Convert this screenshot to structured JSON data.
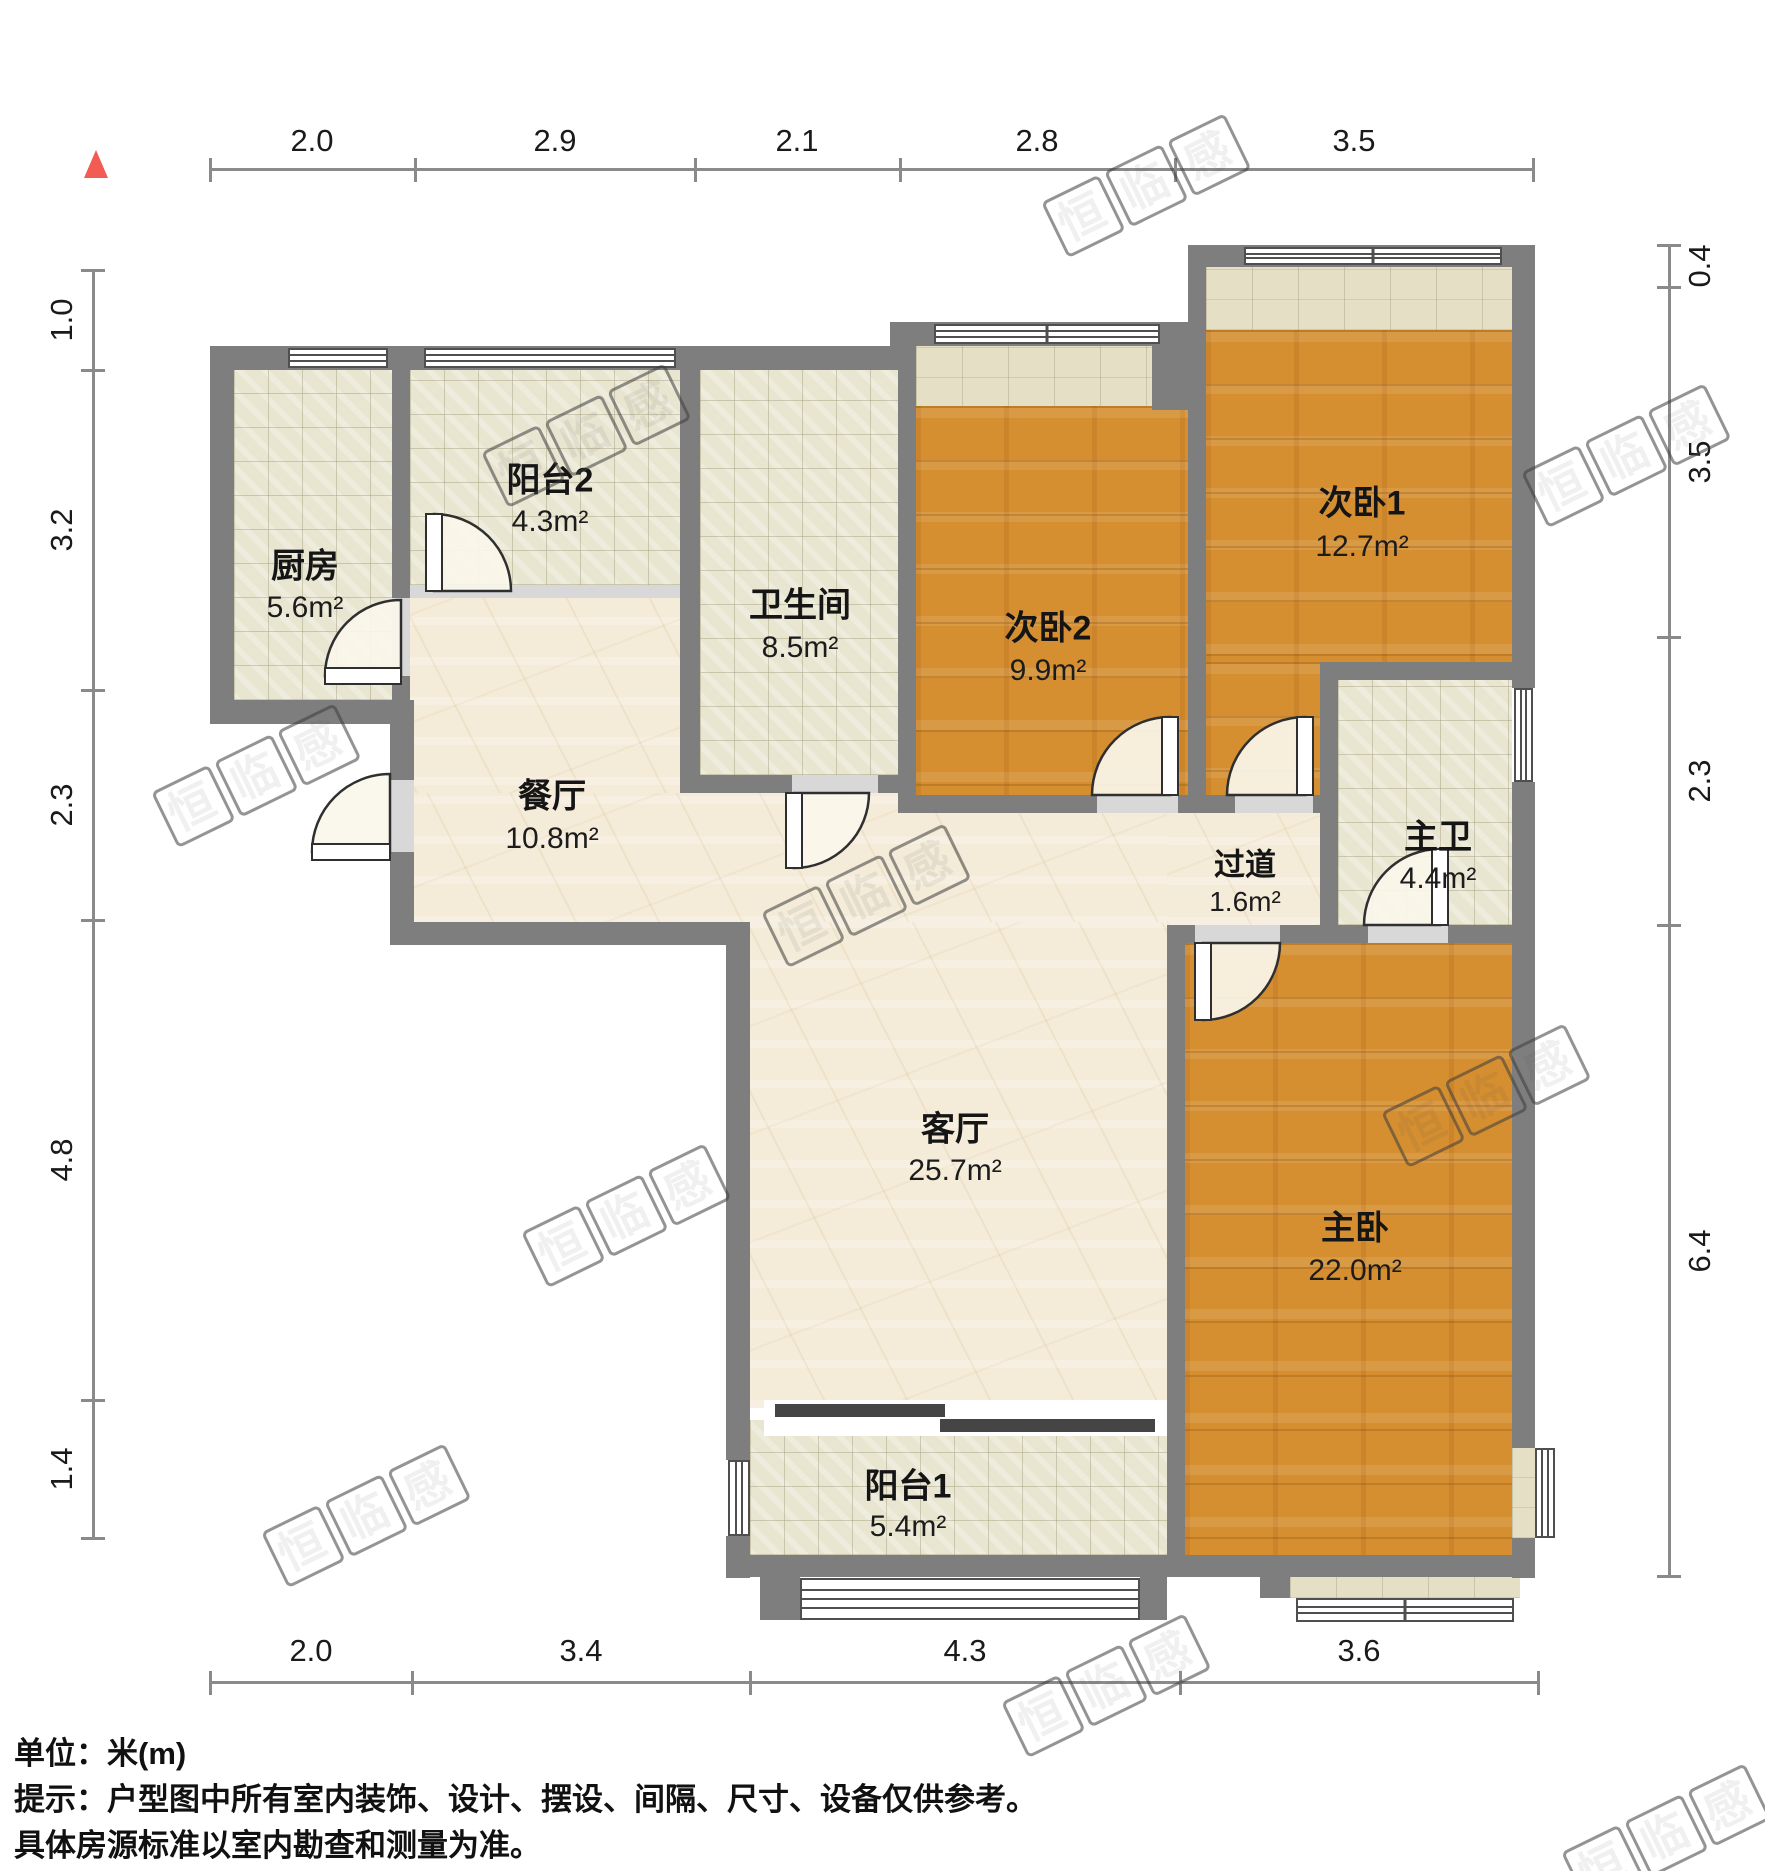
{
  "title": "户型图",
  "unit_scale": "米(m)",
  "compass": {
    "icon": "north-arrow",
    "color": "#f25c54"
  },
  "rooms": {
    "kitchen": {
      "name": "厨房",
      "area": "5.6m²"
    },
    "balcony2": {
      "name": "阳台2",
      "area": "4.3m²"
    },
    "bathroom": {
      "name": "卫生间",
      "area": "8.5m²"
    },
    "bedroom2": {
      "name": "次卧2",
      "area": "9.9m²"
    },
    "bedroom1": {
      "name": "次卧1",
      "area": "12.7m²"
    },
    "dining": {
      "name": "餐厅",
      "area": "10.8m²"
    },
    "hallway": {
      "name": "过道",
      "area": "1.6m²"
    },
    "master_bath": {
      "name": "主卫",
      "area": "4.4m²"
    },
    "living": {
      "name": "客厅",
      "area": "25.7m²"
    },
    "master_bedroom": {
      "name": "主卧",
      "area": "22.0m²"
    },
    "balcony1": {
      "name": "阳台1",
      "area": "5.4m²"
    }
  },
  "dimensions": {
    "top": [
      "2.0",
      "2.9",
      "2.1",
      "2.8",
      "3.5"
    ],
    "left": [
      "1.0",
      "3.2",
      "2.3",
      "4.8",
      "1.4"
    ],
    "right": [
      "0.4",
      "3.5",
      "2.3",
      "6.4"
    ],
    "bottom": [
      "2.0",
      "3.4",
      "4.3",
      "3.6"
    ]
  },
  "footer": {
    "unit_line": "单位：米(m)",
    "notice_line1": "提示：户型图中所有室内装饰、设计、摆设、间隔、尺寸、设备仅供参考。",
    "notice_line2": "具体房源标准以室内勘查和测量为准。"
  },
  "watermark": {
    "char1": "恒",
    "char2": "临",
    "char3": "感"
  },
  "colors": {
    "wall": "#7e7e7e",
    "wood_floor": "#d58f31",
    "tile_floor": "#e8e5d0",
    "marble_floor": "#f4ebd8",
    "north_arrow": "#f25c54"
  }
}
